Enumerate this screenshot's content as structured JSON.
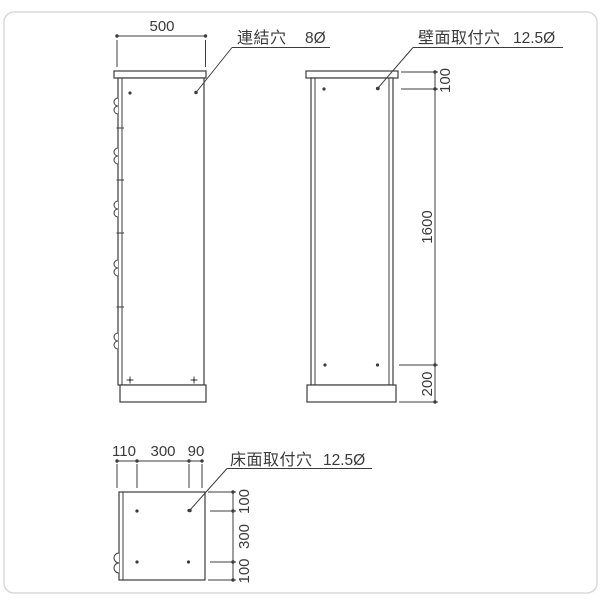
{
  "colors": {
    "line": "#3c3c3c",
    "text": "#3a3a3a",
    "frame": "#d9d9d9",
    "background": "#ffffff"
  },
  "side_view": {
    "width_dim": "500",
    "connect_hole": {
      "label": "連結穴",
      "size": "8Ø"
    }
  },
  "back_view": {
    "wall_hole": {
      "label": "壁面取付穴",
      "size": "12.5Ø"
    },
    "dims": {
      "top": "100",
      "middle": "1600",
      "bottom": "200"
    }
  },
  "bottom_view": {
    "floor_hole": {
      "label": "床面取付穴",
      "size": "12.5Ø"
    },
    "top_dims": {
      "left": "110",
      "middle": "300",
      "right": "90"
    },
    "right_dims": {
      "top": "100",
      "middle": "300",
      "bottom": "100"
    }
  }
}
